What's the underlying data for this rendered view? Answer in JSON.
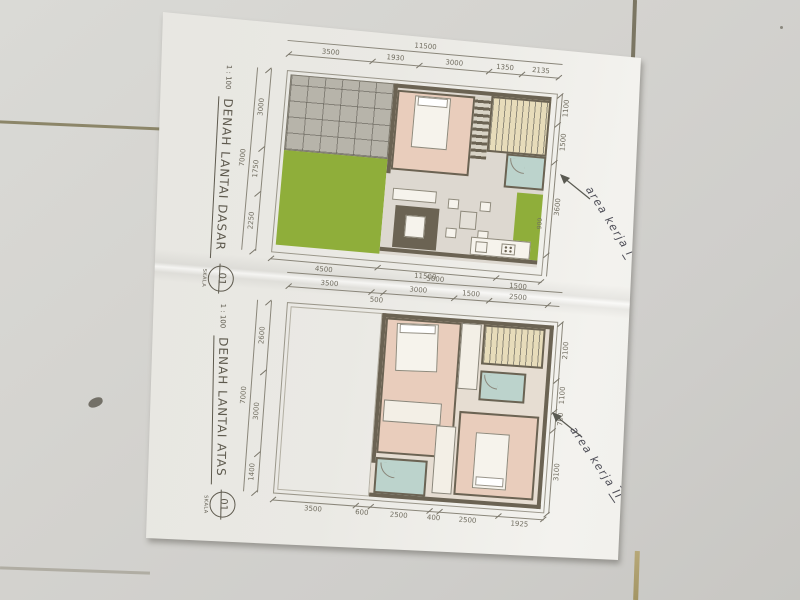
{
  "colors": {
    "wall": "#6b6353",
    "grass": "#8fae3a",
    "room_pink": "#e9cdbc",
    "room_teal": "#bcd3cc",
    "stairs_cream": "#e7dcba",
    "carport_gray": "#b7b4aa",
    "ink": "#4f4f58",
    "paper": "#edece7",
    "tile": "#d3d2ce",
    "grout": "#8c8669",
    "dim_line": "#8a867a"
  },
  "plans": [
    {
      "title": "DENAH LANTAI DASAR",
      "scale_ratio": "1 : 100",
      "skala_label": "SKALA",
      "sheet_number": "01",
      "annotation_text": "area kerja",
      "annotation_numeral": "I",
      "dims": {
        "top_total": "11500",
        "top_segments": [
          "3500",
          "1930",
          "3000",
          "1350",
          "2135"
        ],
        "left_total": "7000",
        "left_segments": [
          "3000",
          "1750",
          "2250"
        ],
        "right_segments": [
          "1100",
          "1500",
          "3600"
        ],
        "right_inner": "900",
        "bottom_segments": [
          "4500",
          "5000",
          "1500"
        ]
      }
    },
    {
      "title": "DENAH LANTAI ATAS",
      "scale_ratio": "1 : 100",
      "skala_label": "SKALA",
      "sheet_number": "01",
      "annotation_text": "area kerja",
      "annotation_numeral": "II",
      "dims": {
        "top_total": "11500",
        "top_segments": [
          "3500",
          "500",
          "3000",
          "1500",
          "2500"
        ],
        "left_total": "7000",
        "left_segments": [
          "2600",
          "3000",
          "1400"
        ],
        "right_segments": [
          "2100",
          "1100",
          "700",
          "3100"
        ],
        "bottom_segments": [
          "3500",
          "600",
          "2500",
          "400",
          "2500",
          "1925"
        ]
      }
    }
  ]
}
